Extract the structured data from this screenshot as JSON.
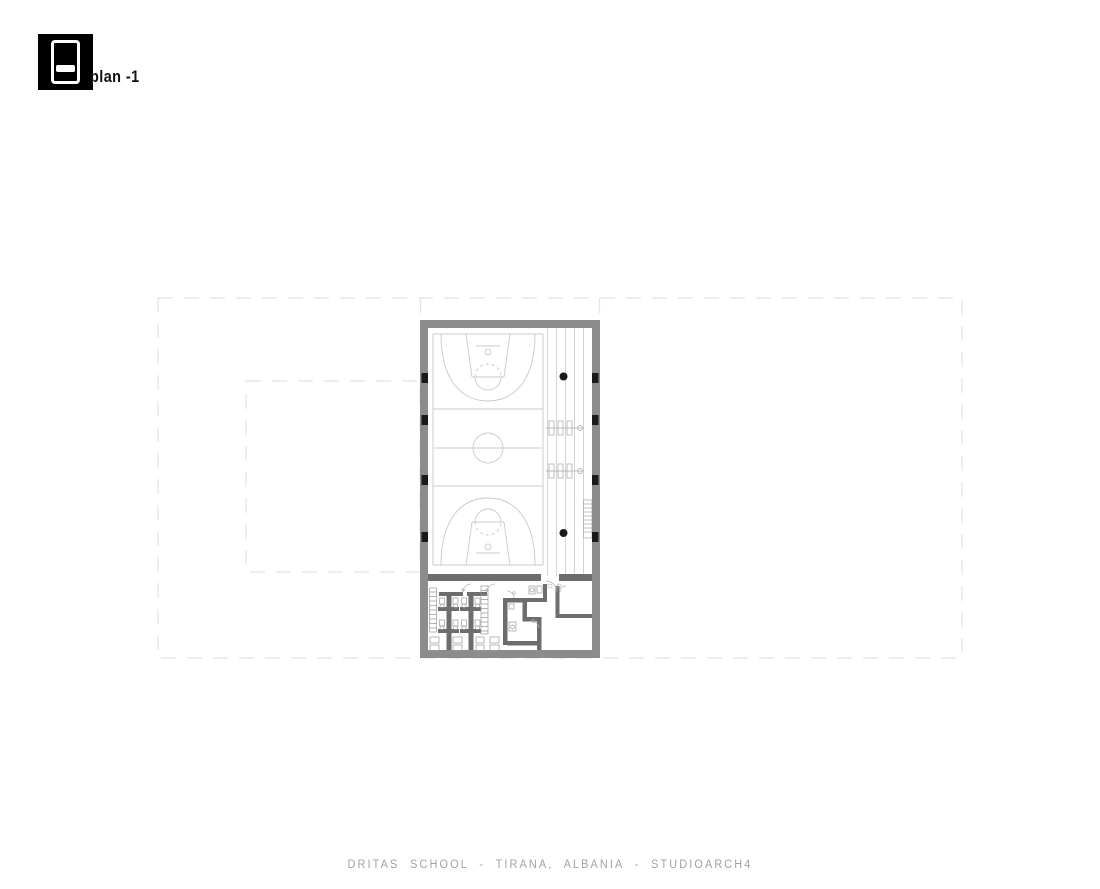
{
  "sheet": {
    "title": "plan -1",
    "caption": "DRITAS SCHOOL - TIRANA, ALBANIA - STUDIOARCH4",
    "logo": {
      "icon": "floor-level-indicator-icon",
      "description": "black square with stacked level blocks, middle band highlighted"
    }
  },
  "plan": {
    "level_label": "-1",
    "elements": [
      "ghost-outline-of-upper-floor",
      "ghost-outline-of-courtyard",
      "gym-hall-perimeter-walls",
      "basketball-court-markings",
      "center-circle",
      "free-throw-circles",
      "three-point-arcs",
      "bleacher-rows",
      "gym-benches",
      "structural-columns",
      "round-columns",
      "staircase",
      "locker-rooms",
      "toilet-stalls",
      "sanitary-fixtures",
      "door-swings"
    ],
    "colors": {
      "perimeter_wall": "#8c8c8c",
      "partition_wall": "#6d6d6d",
      "column_black": "#1a1a1a",
      "court_line": "#c9c9c9",
      "bleacher_line": "#d4d4d4",
      "ghost_outline": "#e4e4e4",
      "fixture_line": "#9a9a9a",
      "caption_text": "#a2a2a2",
      "title_text": "#111111"
    }
  }
}
